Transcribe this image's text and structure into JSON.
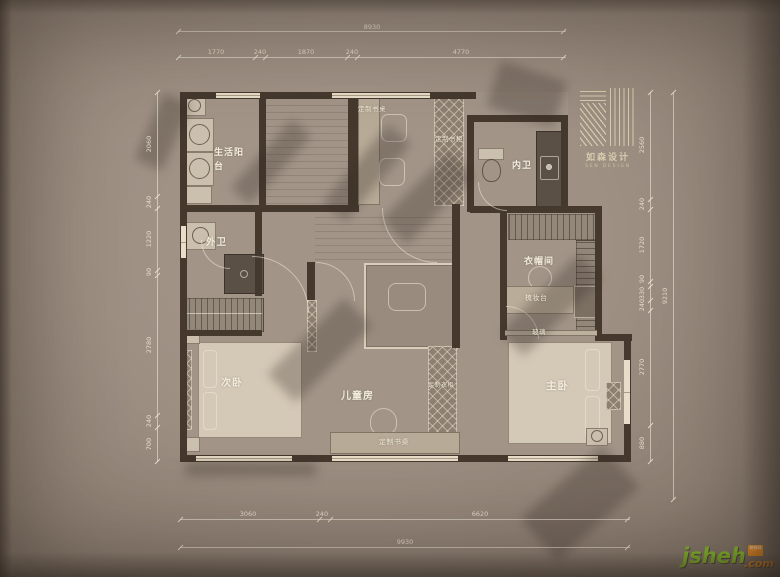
{
  "logo": {
    "cn": "如森设计",
    "en": "SEN DESIGN"
  },
  "watermark": {
    "brand": "jsheh",
    "tld": ".com",
    "badge": "装修网"
  },
  "rooms": {
    "laundry_balcony": "生活阳台",
    "guest_bath": "外卫",
    "second_bedroom": "次卧",
    "kids_room": "儿童房",
    "master_bedroom": "主卧",
    "master_bath": "内卫",
    "cloakroom": "衣帽间"
  },
  "furniture": {
    "desk_top": "定制书桌",
    "bookcase": "定制书柜",
    "wardrobe": "定制衣柜",
    "desk_bottom": "定制书桌",
    "vanity": "梳妆台",
    "glass": "玻璃"
  },
  "dimensions": {
    "top_total": "8930",
    "top_chain": [
      "1770",
      "240",
      "1870",
      "240",
      "4770"
    ],
    "left_chain": [
      "2060",
      "240",
      "1220",
      "90",
      "2780",
      "240",
      "700"
    ],
    "right_chain": [
      "2560",
      "240",
      "1720",
      "90",
      "330",
      "240",
      "2770",
      "880"
    ],
    "right_total": "9210",
    "bottom_chain": [
      "3060",
      "240",
      "6620"
    ],
    "bottom_total": "9930"
  },
  "colors": {
    "wall": "#45392e",
    "cream": "#f3ecdc",
    "green": "#86bc2a",
    "orange": "#f6921e"
  }
}
